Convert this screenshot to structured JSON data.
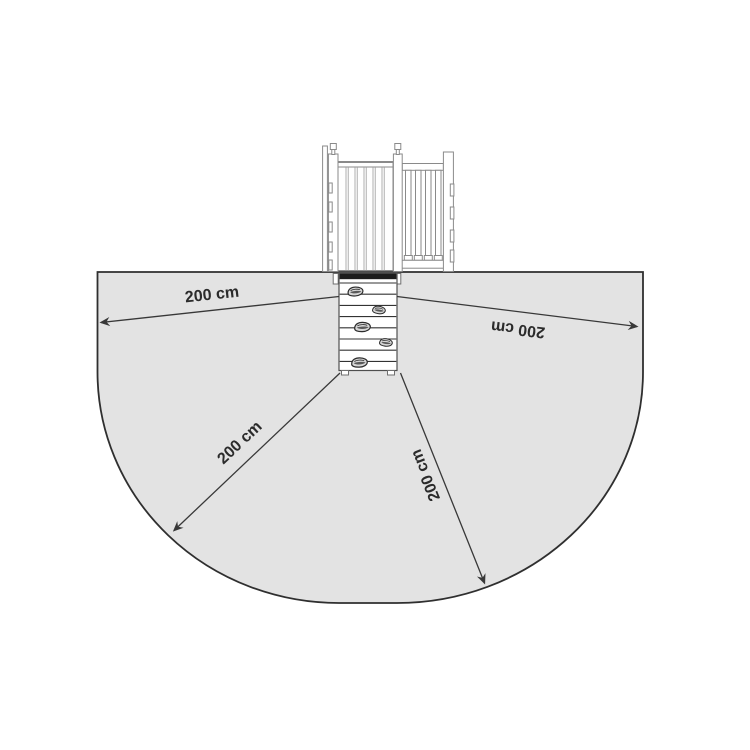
{
  "measurements": [
    {
      "position": "left",
      "value": "200 cm"
    },
    {
      "position": "right",
      "value": "200 cm"
    },
    {
      "position": "bottom_left",
      "value": "200 cm"
    },
    {
      "position": "bottom_right",
      "value": "200 cm"
    }
  ],
  "colors": {
    "background": "#ffffff",
    "zone_fill": "#e3e3e3",
    "zone_stroke": "#2f2f2f",
    "arrow": "#383838",
    "label_text": "#2b2b2b",
    "structure_stroke": "#8a8a8a",
    "wall_top_band": "#1c1c1c"
  },
  "icons": {
    "tower": "playground-tower-front-view",
    "climbing_wall": "climbing-wall-with-holds",
    "safety_zone": "safety-zone-outline",
    "arrowhead": "dimension-arrowhead"
  }
}
